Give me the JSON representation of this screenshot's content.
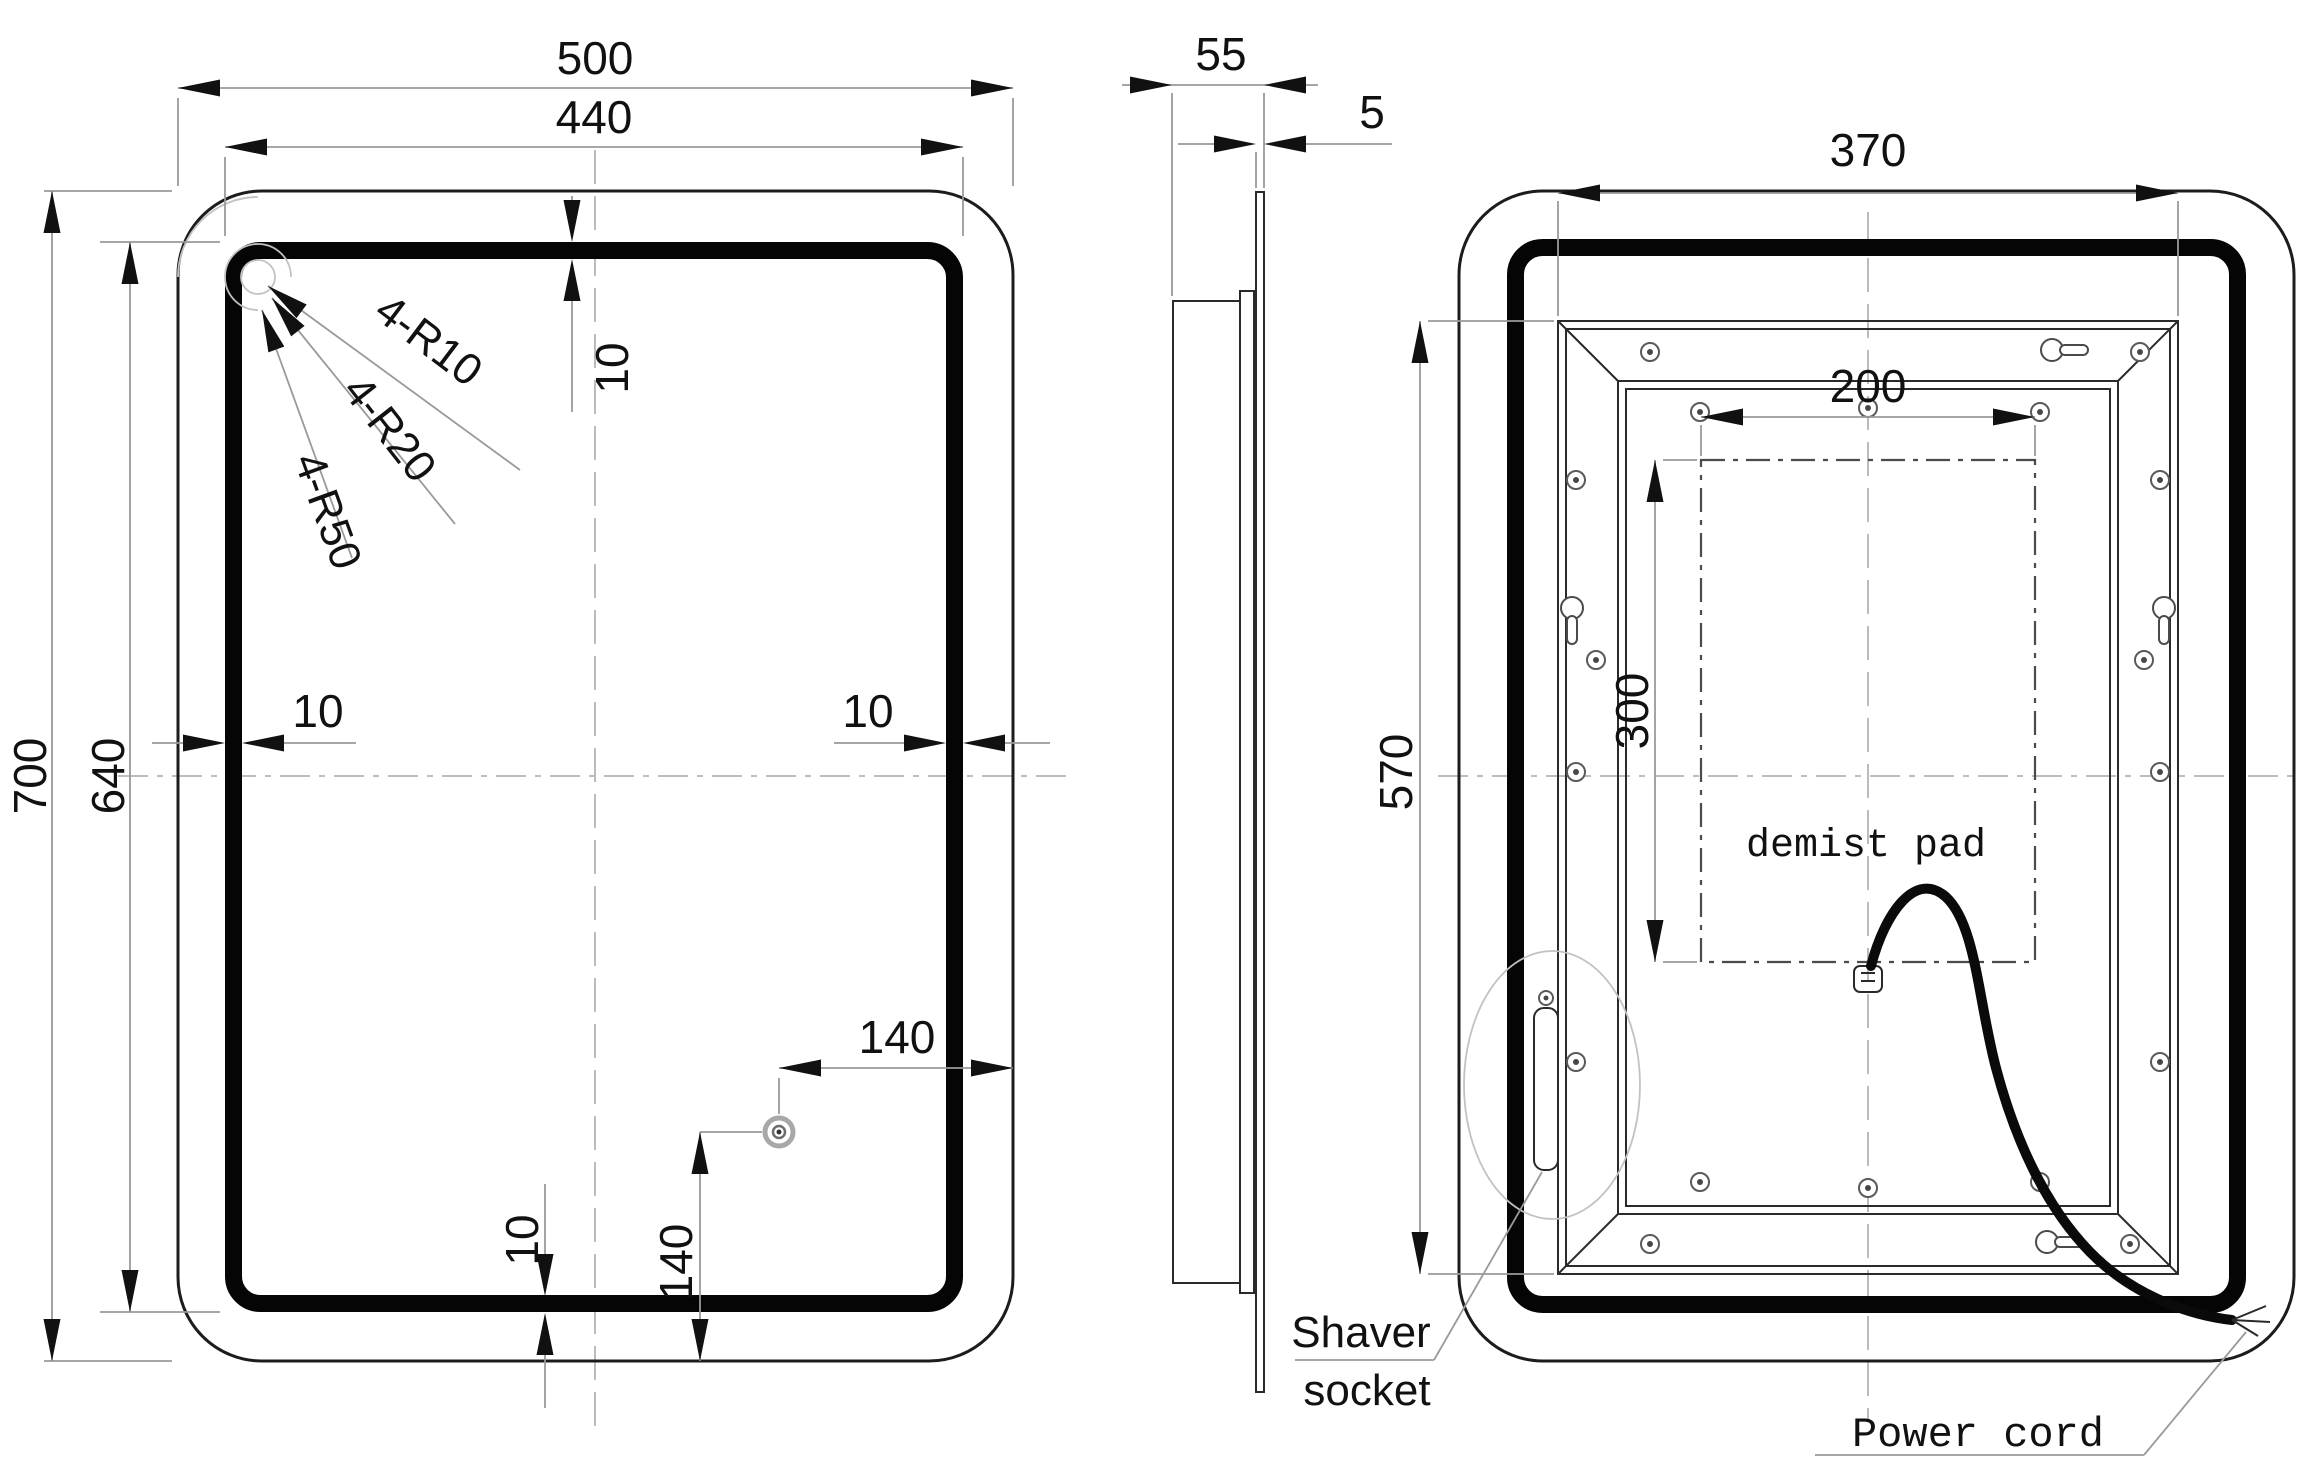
{
  "front_view": {
    "width": "500",
    "led_width": "440",
    "height": "700",
    "led_height": "640",
    "strip_thickness": "10",
    "sensor_offset_x": "140",
    "sensor_offset_y": "140",
    "radii": [
      "4-R10",
      "4-R20",
      "4-R50"
    ]
  },
  "side_view": {
    "depth": "55",
    "glass_thickness": "5"
  },
  "back_view": {
    "panel_width": "370",
    "panel_height": "570",
    "pad_width": "200",
    "pad_height": "300",
    "pad_label": "demist pad",
    "shaver_line1": "Shaver",
    "shaver_line2": "socket",
    "power_cord_label": "Power cord"
  }
}
